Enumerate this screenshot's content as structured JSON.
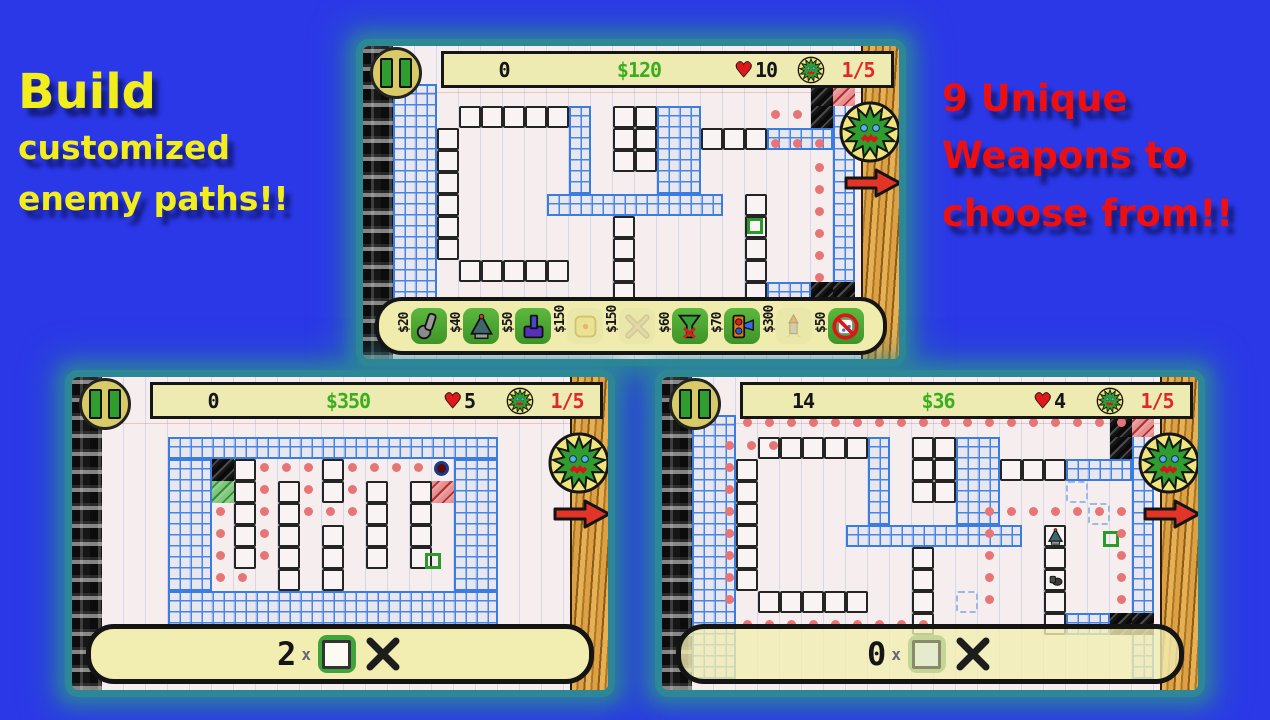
{
  "background": {
    "page_blue": "#2b38e8",
    "glow_teal": "#2d8896"
  },
  "promo_left": {
    "line1": "Build",
    "line2": "customized",
    "line3": "enemy paths!!"
  },
  "promo_right": {
    "line1": "9 Unique",
    "line2": "Weapons to",
    "line3": "choose from!!"
  },
  "colors": {
    "money_green": "#3aae1f",
    "wave_red": "#e02828",
    "path_dot": "#e87575",
    "grid_blue": "#3a7ce0",
    "hud_bg": "#edeab2"
  },
  "shots": [
    {
      "hud": {
        "score": "0",
        "money": "$120",
        "lives": "10",
        "wave": "1/5"
      },
      "toolbar": {
        "weapons": [
          {
            "price": "$20",
            "icon": "club",
            "enabled": true
          },
          {
            "price": "$40",
            "icon": "cone",
            "enabled": true
          },
          {
            "price": "$50",
            "icon": "cannon",
            "enabled": true
          },
          {
            "price": "$150",
            "icon": "pad",
            "enabled": false
          },
          {
            "price": "$150",
            "icon": "xtrap",
            "enabled": false
          },
          {
            "price": "$60",
            "icon": "funnel",
            "enabled": true
          },
          {
            "price": "$70",
            "icon": "signal",
            "enabled": true
          },
          {
            "price": "$300",
            "icon": "rocket",
            "enabled": false
          },
          {
            "price": "$50",
            "icon": "nosign",
            "enabled": true
          }
        ]
      },
      "map": {
        "blue_rects": [
          [
            0,
            0,
            2,
            10
          ],
          [
            20,
            0,
            1,
            10
          ],
          [
            8,
            1,
            1,
            4
          ],
          [
            12,
            1,
            2,
            4
          ],
          [
            7,
            5,
            8,
            1
          ],
          [
            17,
            2,
            3,
            1
          ],
          [
            17,
            9,
            2,
            1
          ]
        ],
        "walls": [
          [
            3,
            1,
            5,
            1
          ],
          [
            2,
            2,
            1,
            6
          ],
          [
            3,
            8,
            5,
            1
          ],
          [
            10,
            1,
            2,
            3
          ],
          [
            10,
            6,
            1,
            4
          ],
          [
            14,
            2,
            3,
            1
          ],
          [
            16,
            5,
            1,
            5
          ]
        ],
        "hatch_black": [
          [
            19,
            0
          ],
          [
            19,
            1
          ],
          [
            19,
            9
          ],
          [
            20,
            9
          ]
        ],
        "hatch_red": [
          [
            20,
            0
          ]
        ],
        "hatch_green": [],
        "ghosts": [],
        "green_squares": [
          [
            16,
            6
          ]
        ],
        "end_circles": [],
        "towers": [],
        "red_dots": [
          [
            17.4,
            1.4
          ],
          [
            18.4,
            1.4
          ],
          [
            17.4,
            2.7
          ],
          [
            18.4,
            2.7
          ],
          [
            19.4,
            2.7
          ],
          [
            19.4,
            3.8
          ],
          [
            19.4,
            4.8
          ],
          [
            19.4,
            5.8
          ],
          [
            19.4,
            6.8
          ],
          [
            19.4,
            7.8
          ],
          [
            19.4,
            8.8
          ]
        ]
      }
    },
    {
      "hud": {
        "score": "0",
        "money": "$350",
        "lives": "5",
        "wave": "1/5"
      },
      "pillbar": {
        "count": "2",
        "times": "x"
      },
      "map": {
        "blue_rects": [
          [
            3,
            1,
            15,
            1
          ],
          [
            3,
            8,
            15,
            2
          ],
          [
            3,
            2,
            2,
            6
          ],
          [
            16,
            2,
            2,
            6
          ]
        ],
        "walls": [
          [
            6,
            2,
            1,
            5
          ],
          [
            8,
            3,
            1,
            5
          ],
          [
            10,
            2,
            1,
            2
          ],
          [
            10,
            5,
            1,
            3
          ],
          [
            12,
            3,
            1,
            4
          ],
          [
            14,
            3,
            1,
            4
          ]
        ],
        "hatch_black": [
          [
            5,
            2
          ]
        ],
        "hatch_red": [
          [
            15,
            3
          ]
        ],
        "hatch_green": [
          [
            5,
            3
          ]
        ],
        "ghosts": [],
        "green_squares": [
          [
            14.6,
            6.2
          ]
        ],
        "end_circles": [
          [
            15,
            2
          ]
        ],
        "towers": [],
        "red_dots": [
          [
            5.4,
            4.4
          ],
          [
            5.4,
            5.4
          ],
          [
            5.4,
            6.4
          ],
          [
            5.4,
            7.4
          ],
          [
            6.4,
            7.4
          ],
          [
            7.4,
            6.4
          ],
          [
            7.4,
            5.4
          ],
          [
            7.4,
            4.4
          ],
          [
            7.4,
            3.4
          ],
          [
            7.4,
            2.4
          ],
          [
            8.4,
            2.4
          ],
          [
            9.4,
            2.4
          ],
          [
            9.4,
            3.4
          ],
          [
            9.4,
            4.4
          ],
          [
            10.4,
            4.4
          ],
          [
            11.4,
            4.4
          ],
          [
            11.4,
            3.4
          ],
          [
            11.4,
            2.4
          ],
          [
            12.4,
            2.4
          ],
          [
            13.4,
            2.4
          ],
          [
            14.4,
            2.4
          ]
        ]
      }
    },
    {
      "hud": {
        "score": "14",
        "money": "$36",
        "lives": "4",
        "wave": "1/5"
      },
      "pillbar": {
        "count": "0",
        "times": "x"
      },
      "map": {
        "blue_rects": [
          [
            0,
            0,
            2,
            12
          ],
          [
            20,
            0,
            1,
            12
          ],
          [
            8,
            1,
            1,
            4
          ],
          [
            12,
            1,
            2,
            4
          ],
          [
            7,
            5,
            8,
            1
          ],
          [
            17,
            2,
            3,
            1
          ],
          [
            17,
            9,
            2,
            1
          ]
        ],
        "walls": [
          [
            3,
            1,
            5,
            1
          ],
          [
            2,
            2,
            1,
            6
          ],
          [
            3,
            8,
            5,
            1
          ],
          [
            10,
            1,
            2,
            3
          ],
          [
            10,
            6,
            1,
            4
          ],
          [
            14,
            2,
            3,
            1
          ],
          [
            16,
            5,
            1,
            5
          ]
        ],
        "hatch_black": [
          [
            19,
            0
          ],
          [
            19,
            1
          ],
          [
            19,
            9
          ],
          [
            20,
            9
          ]
        ],
        "hatch_red": [
          [
            20,
            0
          ]
        ],
        "hatch_green": [],
        "ghosts": [
          [
            17,
            3
          ],
          [
            18,
            4
          ],
          [
            12,
            8
          ]
        ],
        "green_squares": [
          [
            18.6,
            5.2
          ]
        ],
        "end_circles": [],
        "towers": [
          [
            16,
            5,
            "cone"
          ],
          [
            16,
            7,
            "knight"
          ]
        ],
        "red_dots": [
          [
            2.5,
            0.35
          ],
          [
            3.5,
            0.35
          ],
          [
            4.5,
            0.35
          ],
          [
            5.5,
            0.35
          ],
          [
            6.5,
            0.35
          ],
          [
            7.5,
            0.35
          ],
          [
            8.5,
            0.35
          ],
          [
            9.5,
            0.35
          ],
          [
            10.5,
            0.35
          ],
          [
            11.5,
            0.35
          ],
          [
            12.5,
            0.35
          ],
          [
            13.5,
            0.35
          ],
          [
            14.5,
            0.35
          ],
          [
            15.5,
            0.35
          ],
          [
            16.5,
            0.35
          ],
          [
            17.5,
            0.35
          ],
          [
            18.5,
            0.35
          ],
          [
            19.5,
            0.35
          ],
          [
            1.7,
            1.4
          ],
          [
            2.7,
            1.4
          ],
          [
            3.7,
            1.4
          ],
          [
            1.7,
            2.4
          ],
          [
            1.7,
            3.4
          ],
          [
            1.7,
            4.4
          ],
          [
            1.7,
            5.4
          ],
          [
            1.7,
            6.4
          ],
          [
            1.7,
            7.4
          ],
          [
            1.7,
            8.4
          ],
          [
            2.5,
            9.5
          ],
          [
            3.5,
            9.5
          ],
          [
            4.5,
            9.5
          ],
          [
            5.5,
            9.5
          ],
          [
            6.5,
            9.5
          ],
          [
            7.5,
            9.5
          ],
          [
            8.5,
            9.5
          ],
          [
            9.5,
            9.5
          ],
          [
            10.5,
            9.5
          ],
          [
            13.5,
            4.4
          ],
          [
            14.5,
            4.4
          ],
          [
            15.5,
            4.4
          ],
          [
            16.5,
            4.4
          ],
          [
            17.5,
            4.4
          ],
          [
            18.5,
            4.4
          ],
          [
            19.5,
            4.4
          ],
          [
            13.5,
            5.4
          ],
          [
            13.5,
            6.4
          ],
          [
            13.5,
            7.4
          ],
          [
            13.5,
            8.4
          ],
          [
            19.5,
            5.4
          ],
          [
            19.5,
            6.4
          ],
          [
            19.5,
            7.4
          ],
          [
            19.5,
            8.4
          ]
        ]
      }
    }
  ]
}
